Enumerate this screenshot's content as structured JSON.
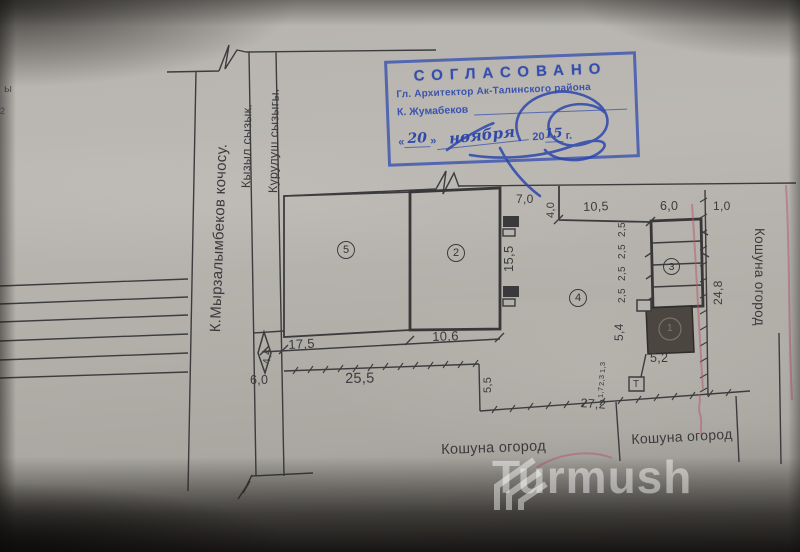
{
  "photo": {
    "edge_fragment_top": "ы",
    "edge_fragment_bottom": "2"
  },
  "plan": {
    "street_label": "К.Мырзалымбеков кочосу.",
    "red_line_label": "Кызыл сызык.",
    "building_line_label": "Курулуш сызыгы.",
    "garden_label_bottom_left": "Кошуна огород",
    "garden_label_bottom_right": "Кошуна огород",
    "garden_label_right_side": "Кошуна огород",
    "t_box_label": "Т",
    "areas": {
      "front_yard": "5",
      "house": "2",
      "shed": "3",
      "back_yard": "4",
      "hatched_building": "1"
    },
    "dims": {
      "d7_0": "7,0",
      "d4_0": "4,0",
      "d10_5": "10,5",
      "d6_0_top": "6,0",
      "d1_0": "1,0",
      "d15_5": "15,5",
      "d2_5": "2,5",
      "d24_8": "24,8",
      "d4_4": "4,4",
      "d17_5": "17,5",
      "d10_6": "10,6",
      "d6_0_front": "6,0",
      "d25_5": "25,5",
      "d5_5": "5,5",
      "d5_4": "5,4",
      "d5_2": "5,2",
      "d27_2": "27,2",
      "d1_7": "1,7",
      "d2_3": "2,3",
      "d1_3": "1,3"
    }
  },
  "stamp": {
    "title": "СОГЛАСОВАНО",
    "line2": "Гл. Архитектор Ак-Талинского района",
    "line3": "К. Жумабеков",
    "open_quote": "«",
    "close_quote": "»",
    "date_day": "20",
    "date_month": "ноября",
    "date_year_printed": "20",
    "date_year_hand": "15",
    "date_suffix": "г."
  },
  "watermark": {
    "text": "Turmush"
  },
  "colors": {
    "ink": "#3b3b3d",
    "stamp_blue": "#3650b0",
    "red_pen": "#b4556e",
    "paper": "#b4b1ac"
  }
}
